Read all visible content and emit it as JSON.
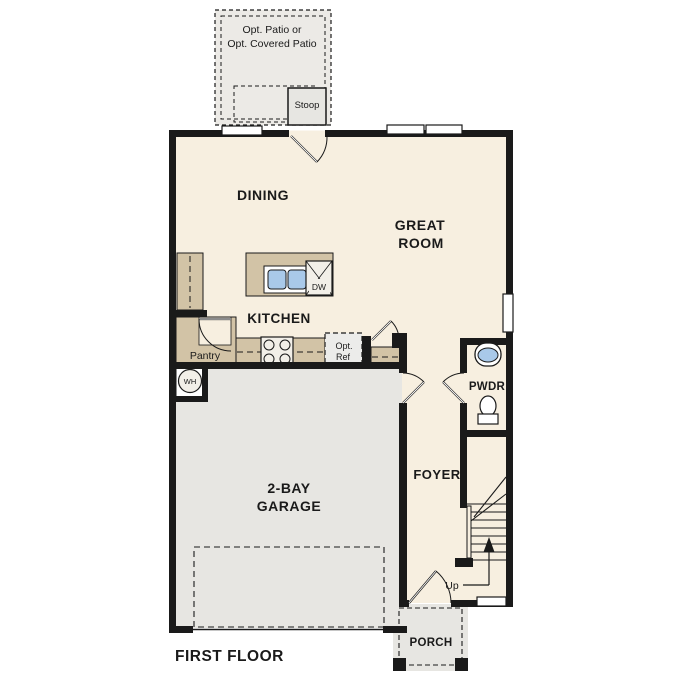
{
  "plan": {
    "title": "FIRST FLOOR",
    "rooms": {
      "dining": "DINING",
      "great_room_line1": "GREAT",
      "great_room_line2": "ROOM",
      "kitchen": "KITCHEN",
      "pantry": "Pantry",
      "garage_line1": "2-BAY",
      "garage_line2": "GARAGE",
      "foyer": "FOYER",
      "powder": "PWDR",
      "porch": "PORCH"
    },
    "features": {
      "opt_patio_line1": "Opt. Patio or",
      "opt_patio_line2": "Opt. Covered Patio",
      "stoop": "Stoop",
      "opt_ref_line1": "Opt.",
      "opt_ref_line2": "Ref",
      "dishwasher": "DW",
      "water_heater": "WH",
      "stairs_up": "Up"
    },
    "colors": {
      "wall": "#1a1a1a",
      "interior_floor": "#f7efe0",
      "concrete": "#e7e6e2",
      "cabinet_tan": "#d2c3a6",
      "fixture_blue": "#a9c9e9",
      "background": "#ffffff"
    }
  }
}
